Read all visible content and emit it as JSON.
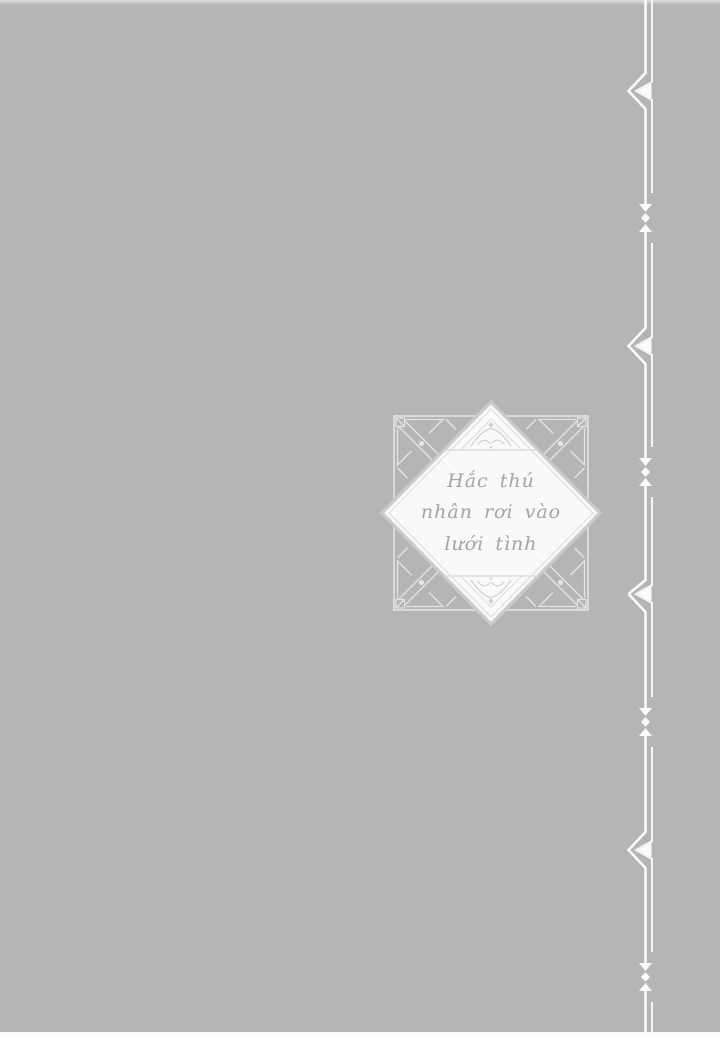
{
  "page": {
    "type_label": "manga page",
    "background_color": "#b5b5b5",
    "bottom_edge_color": "#fdfdfd"
  },
  "emblem": {
    "title": {
      "line1": "Hắc thú",
      "line2": "nhân rơi vào",
      "line3": "lưới tình"
    },
    "text_color": "#a4a4a4",
    "frame_color": "#e4e4e4",
    "diamond_fill_color": "#ffffff",
    "diamond_border_color": "#cbcbcb",
    "icons": [
      "square-frame-ornament",
      "art-deco-corner-icon",
      "diamond-badge",
      "bird-flourish-icon"
    ]
  },
  "right_border": {
    "ornament_color": "#fafafa",
    "icons": [
      "double-vertical-rule",
      "double-chevron-left-icon",
      "arrow-down-icon",
      "diamond-dot-icon",
      "arrow-up-icon"
    ]
  }
}
